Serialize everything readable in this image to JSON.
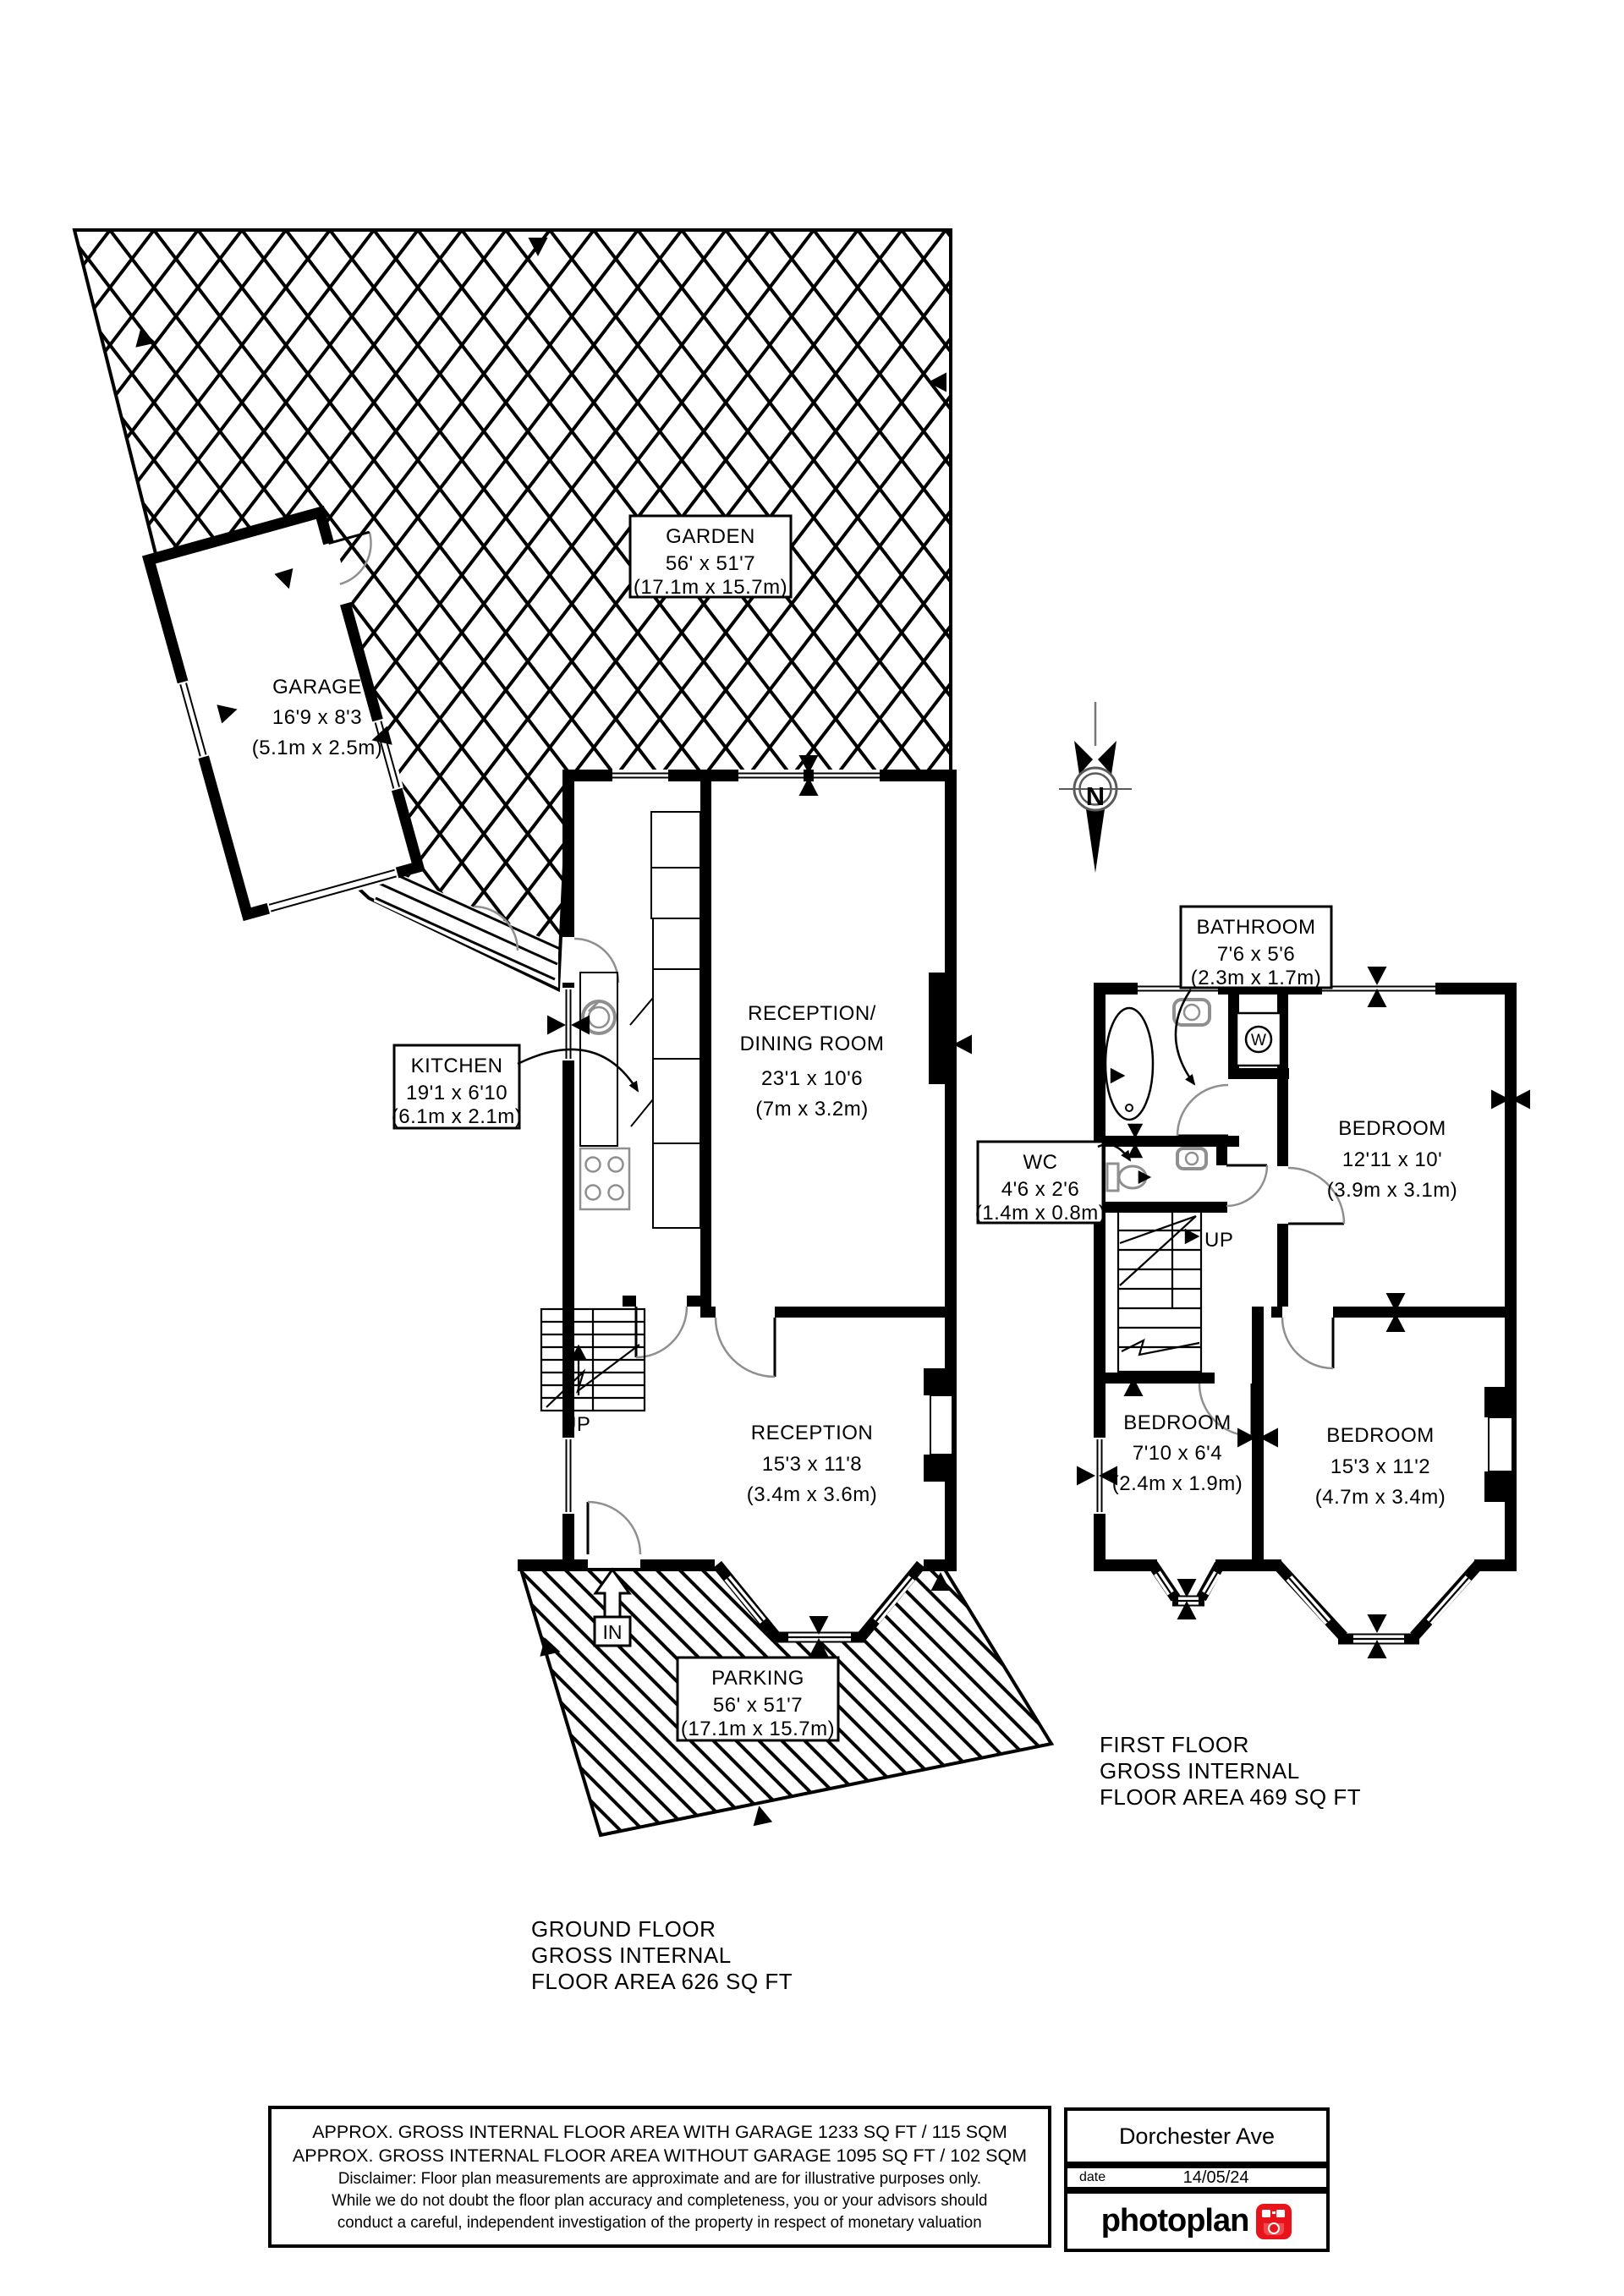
{
  "colors": {
    "ink": "#000000",
    "gray": "#8f8f8f",
    "brand_red": "#e8141c"
  },
  "compass": {
    "label": "N"
  },
  "ground_floor": {
    "caption": [
      "GROUND FLOOR",
      "GROSS INTERNAL",
      "FLOOR AREA 626 SQ FT"
    ],
    "garden": [
      "GARDEN",
      "56' x 51'7",
      "(17.1m x 15.7m)"
    ],
    "garage": [
      "GARAGE",
      "16'9 x 8'3",
      "(5.1m x 2.5m)"
    ],
    "kitchen": [
      "KITCHEN",
      "19'1 x 6'10",
      "(6.1m x 2.1m)"
    ],
    "reception_dining": [
      "RECEPTION/",
      "DINING ROOM",
      "23'1 x 10'6",
      "(7m x 3.2m)"
    ],
    "reception": [
      "RECEPTION",
      "15'3 x 11'8",
      "(3.4m x 3.6m)"
    ],
    "parking": [
      "PARKING",
      "56' x 51'7",
      "(17.1m x 15.7m)"
    ],
    "stairs_label": "UP",
    "entrance_label": "IN"
  },
  "first_floor": {
    "caption": [
      "FIRST FLOOR",
      "GROSS INTERNAL",
      "FLOOR AREA 469 SQ FT"
    ],
    "bathroom": [
      "BATHROOM",
      "7'6 x 5'6",
      "(2.3m x 1.7m)"
    ],
    "wc": [
      "WC",
      "4'6 x 2'6",
      "(1.4m x 0.8m)"
    ],
    "bedroom_rear": [
      "BEDROOM",
      "12'11 x 10'",
      "(3.9m x 3.1m)"
    ],
    "bedroom_small": [
      "BEDROOM",
      "7'10 x 6'4",
      "(2.4m x 1.9m)"
    ],
    "bedroom_front": [
      "BEDROOM",
      "15'3 x 11'2",
      "(4.7m x 3.4m)"
    ],
    "stairs_label": "UP",
    "washer_label": "W"
  },
  "footer": {
    "area_with_garage": "APPROX. GROSS INTERNAL FLOOR AREA WITH GARAGE 1233 SQ FT / 115 SQM",
    "area_without_garage": "APPROX. GROSS INTERNAL FLOOR AREA WITHOUT GARAGE 1095 SQ FT / 102 SQM",
    "disclaimer": [
      "Disclaimer: Floor plan measurements are approximate and are for illustrative purposes only.",
      "While we do not doubt the floor plan accuracy and completeness, you or your advisors should",
      "conduct a careful, independent investigation of the property in respect of monetary valuation"
    ],
    "property_name": "Dorchester Ave",
    "date_label": "date",
    "date_value": "14/05/24",
    "brand": "photoplan"
  }
}
